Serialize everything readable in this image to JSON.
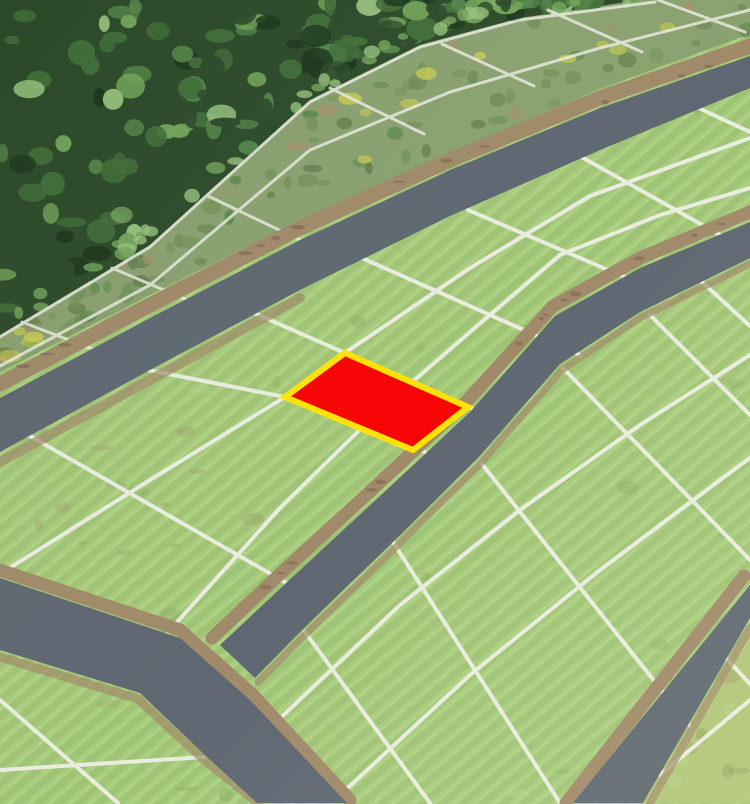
{
  "scene": {
    "kind": "aerial-land-plot-map",
    "highlighted_plot": {
      "name": "selected-plot",
      "fill": "#f70404",
      "border": "#ffe205"
    }
  },
  "colors": {
    "grass": "#a7cb7c",
    "grass_stripe": "#9cc073",
    "grass_light": "#b5d689",
    "road": "#5f6872",
    "dirt": "#a08a6a",
    "line": "#edefe4",
    "forest_base": "#2d4b2b",
    "forest_dark": "#1c371d",
    "forest_mid": "#426f3a",
    "forest_mid2": "#55874a",
    "forest_light": "#74a55c",
    "forest_pale": "#97c17e",
    "scrub_base": "#8aa170",
    "scrub_bush": "#647e4d",
    "scrub_bush2": "#75935c",
    "scrub_ground": "#a3936f",
    "flowers": "#d0d150",
    "rough_grass": "#b2c478",
    "mottle_dark": "#7e9e5d",
    "mottle_brown": "#9a9668"
  },
  "regions": {
    "forest": "forest",
    "scrub": "overgrown-plots",
    "field": "grass-plots",
    "roads": "access-roads",
    "selected": "highlighted-plot"
  }
}
